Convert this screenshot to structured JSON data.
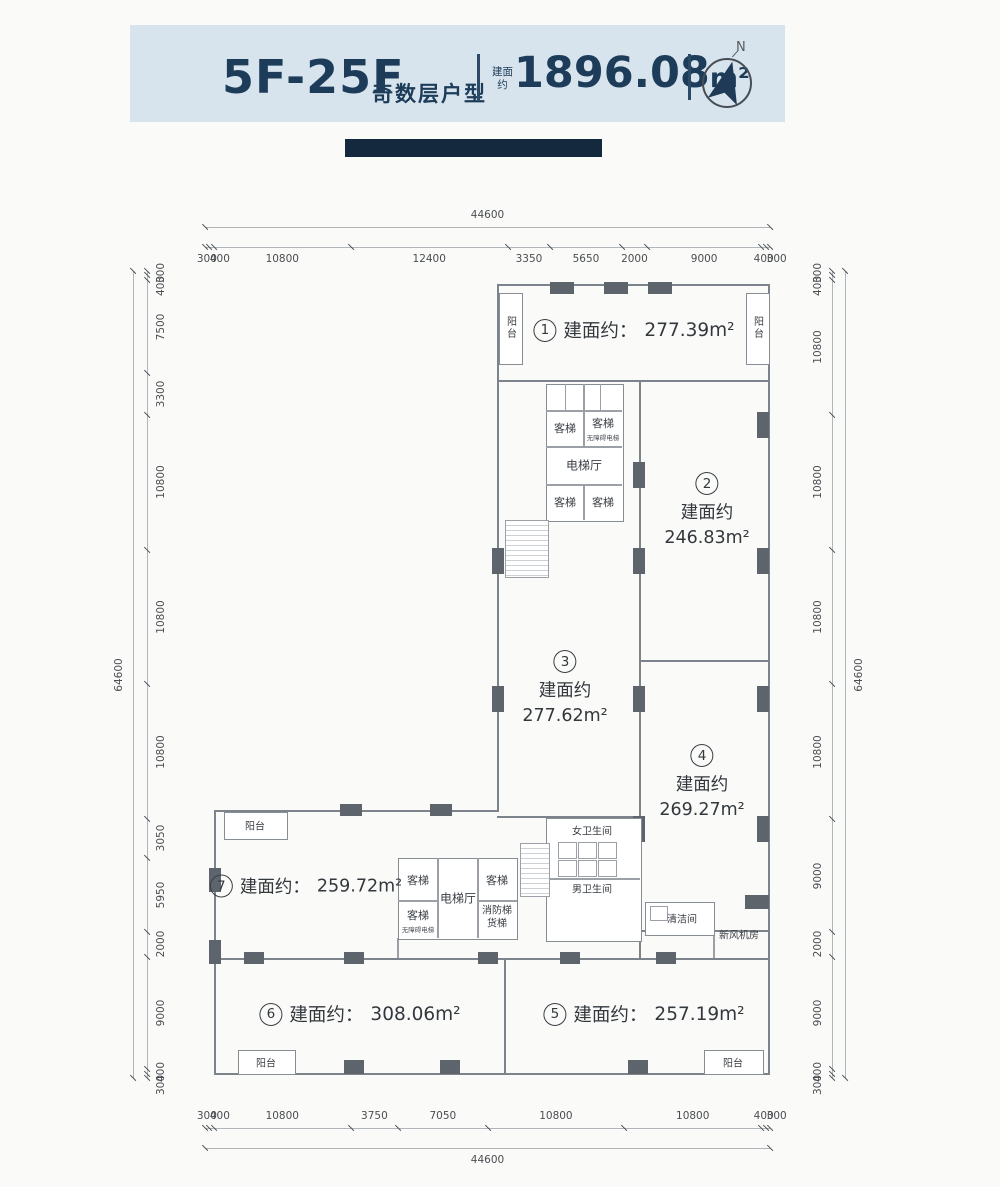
{
  "header": {
    "floor_range": "5F-25F",
    "type_label": "奇数层户型",
    "area_note_line1": "建面",
    "area_note_line2": "约",
    "total_area_value": "1896.08",
    "total_area_unit": "m²",
    "compass_north": "N",
    "accent_color": "#1c3c59",
    "band_color": "#d8e4ed",
    "bar_color": "#15293e"
  },
  "dims": {
    "top": {
      "total": 44600,
      "segments": [
        300,
        400,
        10800,
        12400,
        3350,
        5650,
        2000,
        9000,
        400,
        300
      ]
    },
    "bottom": {
      "total": 44600,
      "segments": [
        300,
        400,
        10800,
        3750,
        7050,
        10800,
        10800,
        400,
        300
      ]
    },
    "left": {
      "total": 64600,
      "segments": [
        300,
        400,
        7500,
        3300,
        10800,
        10800,
        10800,
        3050,
        5950,
        2000,
        9000,
        400,
        300
      ]
    },
    "right": {
      "total": 64600,
      "segments": [
        300,
        400,
        10800,
        10800,
        10800,
        10800,
        9000,
        2000,
        9000,
        400,
        300
      ]
    }
  },
  "units": {
    "u1": {
      "num": "1",
      "prefix": "建面约：",
      "area": "277.39m²"
    },
    "u2": {
      "num": "2",
      "prefix": "建面约",
      "area": "246.83m²"
    },
    "u3": {
      "num": "3",
      "prefix": "建面约",
      "area": "277.62m²"
    },
    "u4": {
      "num": "4",
      "prefix": "建面约",
      "area": "269.27m²"
    },
    "u5": {
      "num": "5",
      "prefix": "建面约：",
      "area": "257.19m²"
    },
    "u6": {
      "num": "6",
      "prefix": "建面约：",
      "area": "308.06m²"
    },
    "u7": {
      "num": "7",
      "prefix": "建面约：",
      "area": "259.72m²"
    }
  },
  "rooms": {
    "balcony": "阳台",
    "passenger_lift": "客梯",
    "accessible_lift": "无障碍电梯",
    "lift_hall": "电梯厅",
    "fire_lift": "消防梯",
    "freight_lift": "货梯",
    "womens_toilet": "女卫生间",
    "mens_toilet": "男卫生间",
    "cleaning_room": "清洁间",
    "fresh_air_room": "新风机房"
  }
}
